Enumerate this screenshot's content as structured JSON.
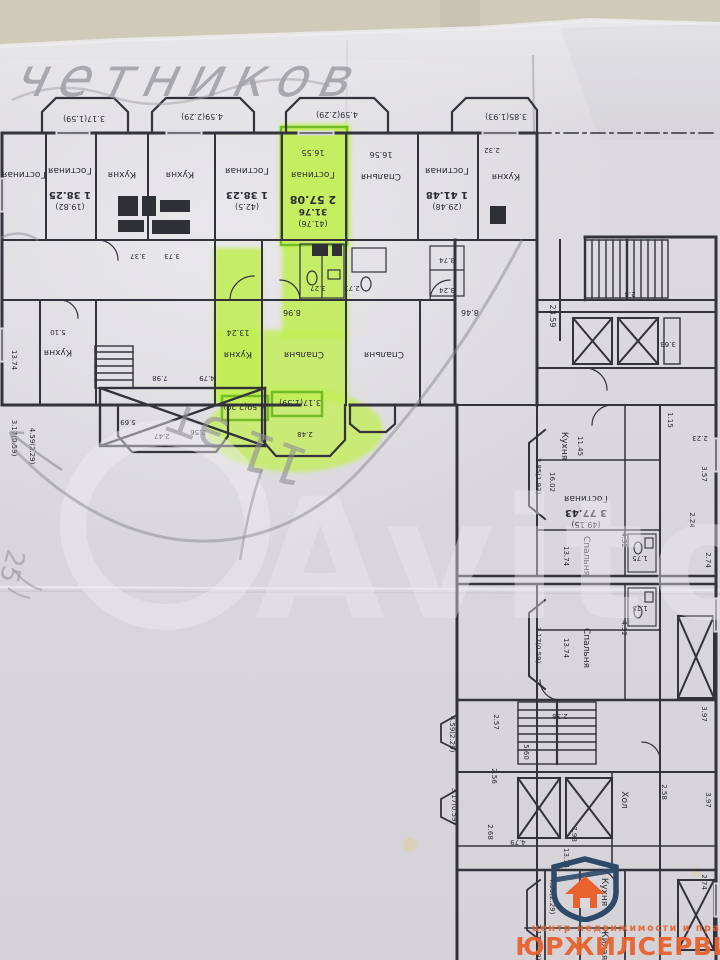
{
  "photo": {
    "wall_color": "#c9c4b2",
    "paper_color": "#dad8dd",
    "line_color": "#2b2b33",
    "highlight_color": "#c1ef52",
    "highlight_outline": "#69b61f",
    "pencil_color": "#8f8e96",
    "accent_orange": "#e8622d",
    "accent_blue": "#2e4a6b"
  },
  "annotations": {
    "handwriting_top": "четников",
    "handwriting_floor": "11 эт",
    "handwriting_side": "25"
  },
  "watermark": {
    "text": "Avito"
  },
  "logo": {
    "tagline": "центр недвижимости и права",
    "name": "ЮРЖИЛСЕРВИС"
  },
  "plan": {
    "labels": [
      {
        "t": "3.17(1.59)",
        "x": 84,
        "y": 116,
        "s": 8
      },
      {
        "t": "4.59(2.29)",
        "x": 202,
        "y": 114,
        "s": 8
      },
      {
        "t": "4.59(2.29)",
        "x": 337,
        "y": 112,
        "s": 8
      },
      {
        "t": "3.85(1.93)",
        "x": 506,
        "y": 114,
        "s": 8
      },
      {
        "t": "Гостиная",
        "x": 24,
        "y": 172
      },
      {
        "t": "Гостиная",
        "x": 70,
        "y": 168
      },
      {
        "t": "1 38.25",
        "x": 70,
        "y": 192,
        "b": 1,
        "s": 10
      },
      {
        "t": "(19.82)",
        "x": 70,
        "y": 204,
        "s": 8
      },
      {
        "t": "Кухня",
        "x": 122,
        "y": 172
      },
      {
        "t": "Кухня",
        "x": 180,
        "y": 172
      },
      {
        "t": "Гостиная",
        "x": 247,
        "y": 168
      },
      {
        "t": "1 38.23",
        "x": 247,
        "y": 192,
        "b": 1,
        "s": 10
      },
      {
        "t": "(42.5)",
        "x": 247,
        "y": 204,
        "s": 8
      },
      {
        "t": "16.55",
        "x": 313,
        "y": 150,
        "s": 8
      },
      {
        "t": "Гостиная",
        "x": 313,
        "y": 172
      },
      {
        "t": "2 57.08",
        "x": 313,
        "y": 196,
        "b": 1,
        "s": 11
      },
      {
        "t": "31.76",
        "x": 313,
        "y": 209,
        "b": 1,
        "s": 9
      },
      {
        "t": "(41.76)",
        "x": 313,
        "y": 221,
        "s": 8
      },
      {
        "t": "16.56",
        "x": 381,
        "y": 152,
        "s": 8
      },
      {
        "t": "Спальня",
        "x": 381,
        "y": 174
      },
      {
        "t": "Гостиная",
        "x": 447,
        "y": 168
      },
      {
        "t": "1 41.48",
        "x": 447,
        "y": 192,
        "b": 1,
        "s": 10
      },
      {
        "t": "(29.48)",
        "x": 447,
        "y": 204,
        "s": 8
      },
      {
        "t": "Кухня",
        "x": 506,
        "y": 174
      },
      {
        "t": "2.32",
        "x": 492,
        "y": 148,
        "s": 7
      },
      {
        "t": "3.37",
        "x": 138,
        "y": 254,
        "s": 7
      },
      {
        "t": "3.73",
        "x": 172,
        "y": 254,
        "s": 7
      },
      {
        "t": "3.27",
        "x": 318,
        "y": 286,
        "s": 7
      },
      {
        "t": "2.73",
        "x": 352,
        "y": 286,
        "s": 7
      },
      {
        "t": "3.74",
        "x": 447,
        "y": 258,
        "s": 7
      },
      {
        "t": "3.24",
        "x": 447,
        "y": 288,
        "s": 7
      },
      {
        "t": "8.96",
        "x": 292,
        "y": 310,
        "s": 8
      },
      {
        "t": "8.46",
        "x": 470,
        "y": 310,
        "s": 8
      },
      {
        "t": "5.10",
        "x": 58,
        "y": 330,
        "s": 7
      },
      {
        "t": "Кухня",
        "x": 58,
        "y": 350
      },
      {
        "t": "13.24",
        "x": 238,
        "y": 330,
        "s": 8
      },
      {
        "t": "Кухня",
        "x": 238,
        "y": 352
      },
      {
        "t": "Спальня",
        "x": 304,
        "y": 352
      },
      {
        "t": "Спальня",
        "x": 384,
        "y": 352
      },
      {
        "t": "7.98",
        "x": 160,
        "y": 376,
        "s": 7
      },
      {
        "t": "4.79",
        "x": 207,
        "y": 376,
        "s": 7
      },
      {
        "t": "5.69",
        "x": 128,
        "y": 420,
        "s": 7
      },
      {
        "t": "2.47",
        "x": 162,
        "y": 434,
        "s": 7
      },
      {
        "t": "2.56",
        "x": 198,
        "y": 430,
        "s": 7
      },
      {
        "t": "2.48",
        "x": 305,
        "y": 432,
        "s": 7
      },
      {
        "t": "13.74",
        "x": 12,
        "y": 360,
        "r": 90,
        "s": 7
      },
      {
        "t": "3.17(0.59)",
        "x": 12,
        "y": 438,
        "r": 90,
        "s": 7
      },
      {
        "t": "4.59(2.29)",
        "x": 30,
        "y": 446,
        "r": 90,
        "s": 7
      },
      {
        "t": "4.59(2.29)",
        "x": 244,
        "y": 404,
        "s": 8
      },
      {
        "t": "3.17(1.59)",
        "x": 300,
        "y": 400,
        "s": 8
      },
      {
        "t": "23.59",
        "x": 550,
        "y": 316,
        "r": 90,
        "s": 8
      },
      {
        "t": "2.4",
        "x": 630,
        "y": 292,
        "s": 7
      },
      {
        "t": "3.63",
        "x": 668,
        "y": 342,
        "s": 7
      },
      {
        "t": "Кухня",
        "x": 562,
        "y": 446,
        "r": 90
      },
      {
        "t": "11.45",
        "x": 578,
        "y": 446,
        "r": 90,
        "s": 7
      },
      {
        "t": "16.02",
        "x": 550,
        "y": 482,
        "r": 90,
        "s": 7
      },
      {
        "t": "3.85(1.93)",
        "x": 536,
        "y": 476,
        "r": 90,
        "s": 7
      },
      {
        "t": "Гостиная",
        "x": 586,
        "y": 496
      },
      {
        "t": "3 77.43",
        "x": 586,
        "y": 510,
        "b": 1,
        "s": 10
      },
      {
        "t": "(49.15)",
        "x": 586,
        "y": 522,
        "s": 8
      },
      {
        "t": "Спальня",
        "x": 584,
        "y": 556,
        "r": 90
      },
      {
        "t": "13.74",
        "x": 564,
        "y": 556,
        "r": 90,
        "s": 7
      },
      {
        "t": "Спальня",
        "x": 584,
        "y": 648,
        "r": 90
      },
      {
        "t": "13.74",
        "x": 564,
        "y": 648,
        "r": 90,
        "s": 7
      },
      {
        "t": "3.17(0.59)",
        "x": 536,
        "y": 645,
        "r": 90,
        "s": 7
      },
      {
        "t": "1.75",
        "x": 640,
        "y": 556,
        "s": 7
      },
      {
        "t": "1.75",
        "x": 640,
        "y": 606,
        "s": 7
      },
      {
        "t": "4.32",
        "x": 622,
        "y": 540,
        "r": 90,
        "s": 7
      },
      {
        "t": "4.32",
        "x": 622,
        "y": 628,
        "r": 90,
        "s": 7
      },
      {
        "t": "1.15",
        "x": 668,
        "y": 420,
        "r": 90,
        "s": 7
      },
      {
        "t": "2.23",
        "x": 700,
        "y": 436,
        "s": 7
      },
      {
        "t": "3.57",
        "x": 702,
        "y": 474,
        "r": 90,
        "s": 7
      },
      {
        "t": "2.24",
        "x": 690,
        "y": 520,
        "r": 90,
        "s": 7
      },
      {
        "t": "2.74",
        "x": 706,
        "y": 560,
        "r": 90,
        "s": 7
      },
      {
        "t": "2.38",
        "x": 560,
        "y": 714,
        "s": 7
      },
      {
        "t": "2.57",
        "x": 494,
        "y": 722,
        "r": 90,
        "s": 7
      },
      {
        "t": "5.60",
        "x": 524,
        "y": 752,
        "r": 90,
        "s": 7
      },
      {
        "t": "2.56",
        "x": 492,
        "y": 776,
        "r": 90,
        "s": 7
      },
      {
        "t": "2.68",
        "x": 488,
        "y": 832,
        "r": 90,
        "s": 7
      },
      {
        "t": "4.79",
        "x": 518,
        "y": 840,
        "s": 7
      },
      {
        "t": "7.98",
        "x": 572,
        "y": 834,
        "r": 90,
        "s": 7
      },
      {
        "t": "Хол",
        "x": 622,
        "y": 800,
        "r": 90
      },
      {
        "t": "3.97",
        "x": 702,
        "y": 714,
        "r": 90,
        "s": 7
      },
      {
        "t": "3.97",
        "x": 706,
        "y": 800,
        "r": 90,
        "s": 7
      },
      {
        "t": "2.58",
        "x": 662,
        "y": 792,
        "r": 90,
        "s": 7
      },
      {
        "t": "4.59(2.29)",
        "x": 450,
        "y": 734,
        "r": 90,
        "s": 7
      },
      {
        "t": "3.17(0.59)",
        "x": 452,
        "y": 806,
        "r": 90,
        "s": 7
      },
      {
        "t": "13.74",
        "x": 564,
        "y": 858,
        "r": 90,
        "s": 7
      },
      {
        "t": "Кухня",
        "x": 602,
        "y": 892,
        "r": 90
      },
      {
        "t": "Жилая",
        "x": 602,
        "y": 944,
        "r": 90
      },
      {
        "t": "4.59(2.29)",
        "x": 550,
        "y": 896,
        "r": 90,
        "s": 7
      },
      {
        "t": "3.17(0.59)",
        "x": 536,
        "y": 942,
        "r": 90,
        "s": 7
      },
      {
        "t": "2.74",
        "x": 702,
        "y": 882,
        "r": 90,
        "s": 7
      }
    ]
  }
}
